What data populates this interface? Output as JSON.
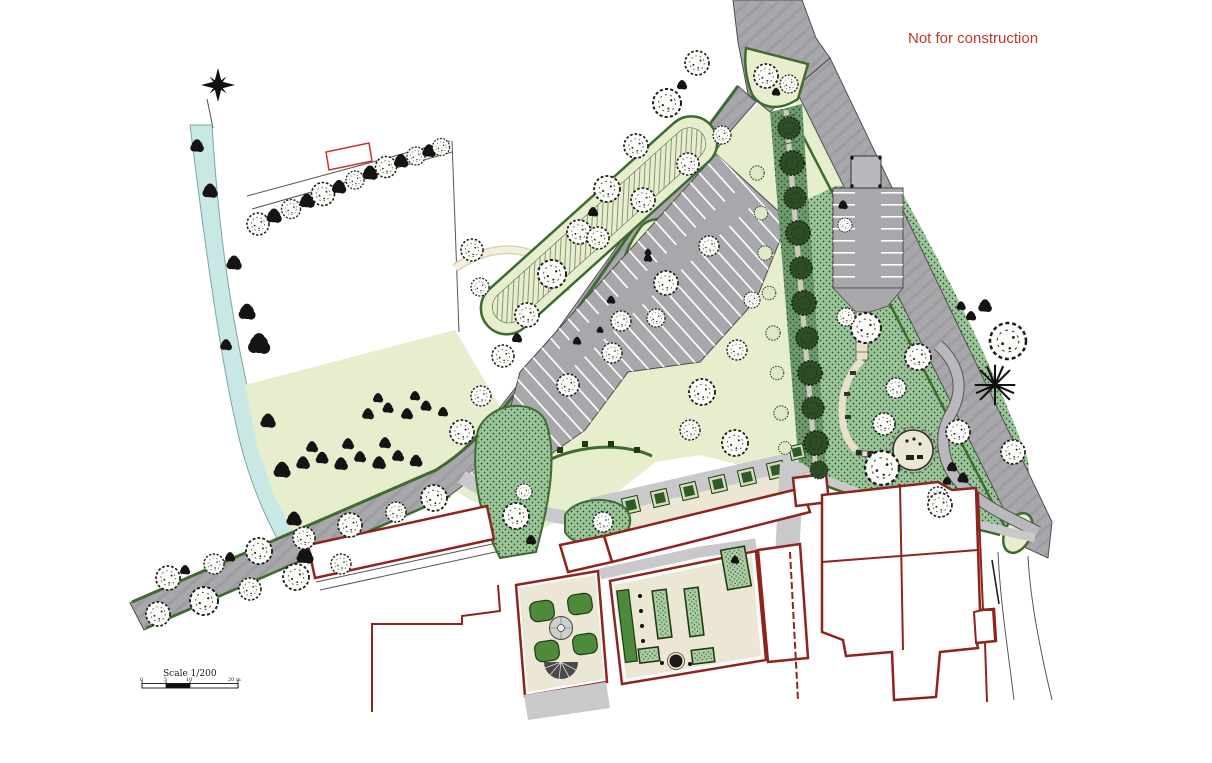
{
  "annotation": {
    "text": "Not for construction",
    "color": "#c0392b"
  },
  "scale_bar": {
    "title": "Scale 1/200",
    "ticks": [
      "0",
      "5",
      "10",
      "20 m"
    ]
  },
  "palette": {
    "road_gray": "#a8a8ac",
    "road_edge": "#4a4a4a",
    "verge": "#e7eecd",
    "garden": "#9cc49a",
    "hedge": "#3e6b30",
    "bed": "#4e8a3c",
    "stream": "#c9e7e4",
    "stream_edge": "#7aa8a2",
    "wall_red": "#8f231d",
    "marker_red": "#cc3333",
    "anno_red": "#c0392b",
    "cream": "#ece6d4",
    "pave": "#c9c9cc",
    "tree_dark": "#141414"
  }
}
